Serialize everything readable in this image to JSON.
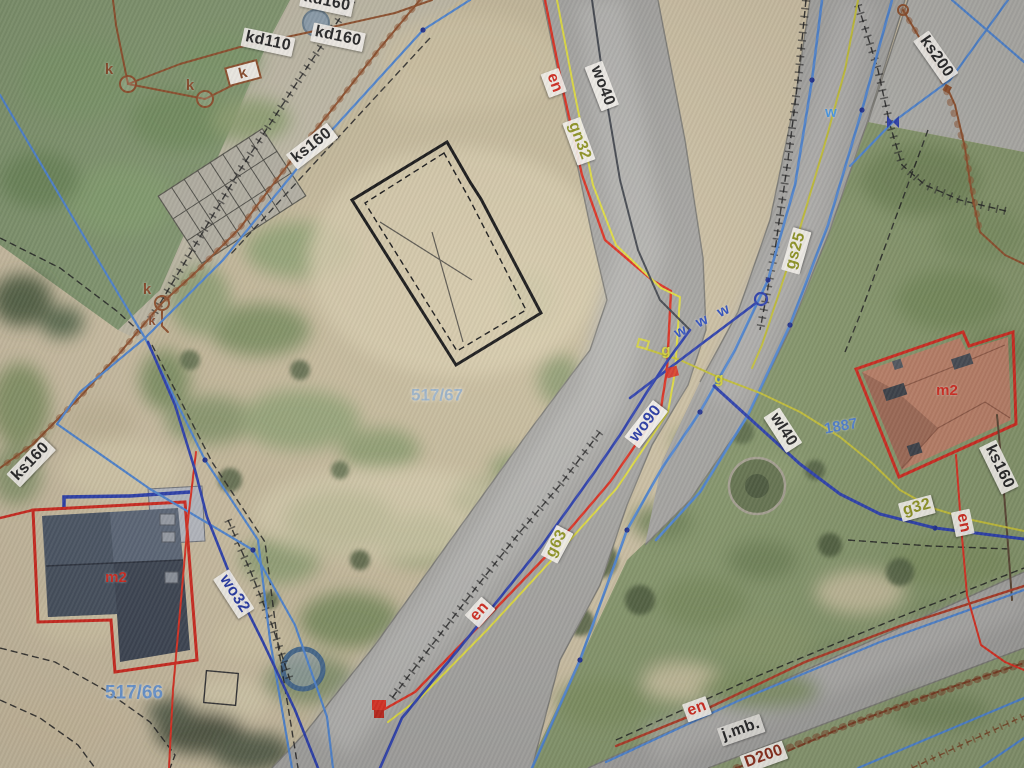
{
  "map": {
    "kind": "aerial cadastral utility map",
    "parcels": [
      "517/67",
      "517/66",
      "1887"
    ],
    "building_marks": [
      "m2",
      "m2"
    ]
  },
  "colors": {
    "water_main_navy": "#2b3fae",
    "water_branch_blue": "#4f86d2",
    "electric_red": "#df2f1f",
    "gas_yellow": "#d9d83a",
    "gas_olive": "#c6c237",
    "sewer_brown": "#8f4f2a",
    "building_outline_red": "#d3281c",
    "foundation_outline_black": "#121212",
    "label_chip": "#fbf8f1"
  },
  "labels": [
    {
      "id": "kd160-top",
      "text": "kd160"
    },
    {
      "id": "kd110",
      "text": "kd110"
    },
    {
      "id": "kd160",
      "text": "kd160"
    },
    {
      "id": "ks160-nw",
      "text": "ks160"
    },
    {
      "id": "wo40",
      "text": "wo40"
    },
    {
      "id": "en-top",
      "text": "en"
    },
    {
      "id": "gn32",
      "text": "gn32"
    },
    {
      "id": "ks200",
      "text": "ks200"
    },
    {
      "id": "gs25",
      "text": "gs25"
    },
    {
      "id": "w-mark",
      "text": "w"
    },
    {
      "id": "w-w-w",
      "text": "w w w"
    },
    {
      "id": "g-mark-1",
      "text": "g"
    },
    {
      "id": "g-mark-2",
      "text": "g"
    },
    {
      "id": "wo90",
      "text": "wo90"
    },
    {
      "id": "wl40",
      "text": "wl40"
    },
    {
      "id": "parcel-1887",
      "text": "1887"
    },
    {
      "id": "m2-right",
      "text": "m2"
    },
    {
      "id": "ks160-e",
      "text": "ks160"
    },
    {
      "id": "g32",
      "text": "g32"
    },
    {
      "id": "en-right",
      "text": "en"
    },
    {
      "id": "ks160-w",
      "text": "ks160"
    },
    {
      "id": "m2-left",
      "text": "m2"
    },
    {
      "id": "wo32",
      "text": "wo32"
    },
    {
      "id": "parcel-517-66",
      "text": "517/66"
    },
    {
      "id": "parcel-517-67",
      "text": "517/67"
    },
    {
      "id": "g63",
      "text": "g63"
    },
    {
      "id": "en-sw",
      "text": "en"
    },
    {
      "id": "en-se",
      "text": "en"
    },
    {
      "id": "jmb",
      "text": "j.mb."
    },
    {
      "id": "d200",
      "text": "D200"
    },
    {
      "id": "k-1",
      "text": "k"
    },
    {
      "id": "k-2",
      "text": "k"
    },
    {
      "id": "k-3",
      "text": "k"
    },
    {
      "id": "k-4",
      "text": "k"
    },
    {
      "id": "k-5",
      "text": "k"
    }
  ]
}
